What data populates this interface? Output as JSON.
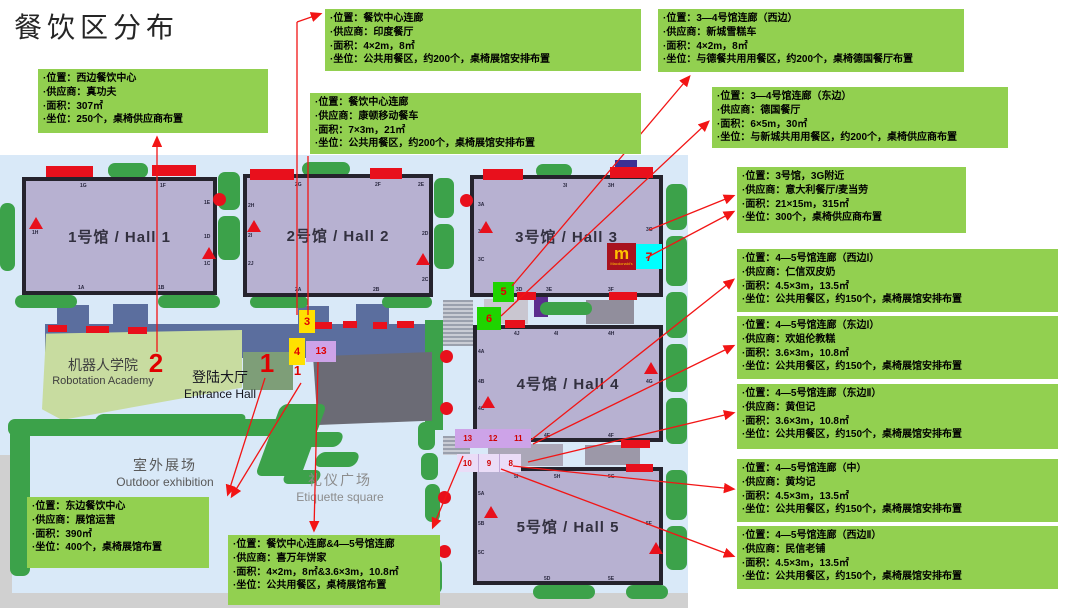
{
  "title": "餐饮区分布",
  "colors": {
    "box_green": "#92D050",
    "arrow_red": "#FF1515",
    "hall_fill": "#B7B1D1",
    "marker_yellow": "#FFE100",
    "marker_green": "#1FD400",
    "marker_cyan": "#00FFFF",
    "marker_purple": "#CDA3E8",
    "map_blue": "#D9E9F8",
    "corridor_blue": "#5B6E9E",
    "tree_green": "#3CA24A",
    "mcdonalds_red": "#A8121E",
    "mcdonalds_yellow": "#FFC300"
  },
  "boxes": [
    {
      "id": "west-dining-center",
      "pos": {
        "x": 38,
        "y": 69,
        "w": 230,
        "h": 64
      },
      "lines": [
        "·位置：西边餐饮中心",
        "·供应商：真功夫",
        "·面积：307㎡",
        "·坐位：250个，桌椅供应商布置"
      ]
    },
    {
      "id": "dining-corridor-india",
      "pos": {
        "x": 325,
        "y": 9,
        "w": 316,
        "h": 62
      },
      "lines": [
        "·位置：餐饮中心连廊",
        "·供应商：印度餐厅",
        "·面积：4×2m，8㎡",
        "·坐位：公共用餐区，约200个，桌椅展馆安排布置"
      ]
    },
    {
      "id": "dining-corridor-kangdun",
      "pos": {
        "x": 310,
        "y": 93,
        "w": 331,
        "h": 61
      },
      "lines": [
        "·位置：餐饮中心连廊",
        "·供应商：康顿移动餐车",
        "·面积：7×3m，21㎡",
        "·坐位：公共用餐区，约200个，桌椅展馆安排布置"
      ]
    },
    {
      "id": "hall34-corridor-west",
      "pos": {
        "x": 658,
        "y": 9,
        "w": 306,
        "h": 63
      },
      "lines": [
        "·位置：3—4号馆连廊（西边）",
        "·供应商：新城雪糕车",
        "·面积：4×2m，8㎡",
        "·坐位：与德餐共用用餐区，约200个，桌椅德国餐厅布置"
      ]
    },
    {
      "id": "hall34-corridor-east",
      "pos": {
        "x": 712,
        "y": 87,
        "w": 296,
        "h": 61
      },
      "lines": [
        "·位置：3—4号馆连廊（东边）",
        "·供应商：德国餐厅",
        "·面积：6×5m，30㎡",
        "·坐位：与新城共用用餐区，约200个，桌椅供应商布置"
      ]
    },
    {
      "id": "hall3-3g",
      "pos": {
        "x": 737,
        "y": 167,
        "w": 229,
        "h": 66
      },
      "lines": [
        "·位置：3号馆，3G附近",
        "·供应商：意大利餐厅/麦当劳",
        "·面积：21×15m，315㎡",
        "·坐位：300个，桌椅供应商布置"
      ]
    },
    {
      "id": "hall45-corridor-west1",
      "pos": {
        "x": 737,
        "y": 249,
        "w": 321,
        "h": 63
      },
      "lines": [
        "·位置：4—5号馆连廊（西边Ⅰ）",
        "·供应商：仁信双皮奶",
        "·面积：4.5×3m，13.5㎡",
        "·坐位：公共用餐区，约150个，桌椅展馆安排布置"
      ]
    },
    {
      "id": "hall45-corridor-east1",
      "pos": {
        "x": 737,
        "y": 316,
        "w": 321,
        "h": 63
      },
      "lines": [
        "·位置：4—5号馆连廊（东边Ⅰ）",
        "·供应商：欢姐伦教糕",
        "·面积：3.6×3m，10.8㎡",
        "·坐位：公共用餐区，约150个，桌椅展馆安排布置"
      ]
    },
    {
      "id": "hall45-corridor-east2",
      "pos": {
        "x": 737,
        "y": 384,
        "w": 321,
        "h": 65
      },
      "lines": [
        "·位置：4—5号馆连廊（东边Ⅱ）",
        "·供应商：黄但记",
        "·面积：3.6×3m，10.8㎡",
        "·坐位：公共用餐区，约150个，桌椅展馆安排布置"
      ]
    },
    {
      "id": "hall45-corridor-mid",
      "pos": {
        "x": 737,
        "y": 459,
        "w": 321,
        "h": 63
      },
      "lines": [
        "·位置：4—5号馆连廊（中）",
        "·供应商：黄均记",
        "·面积：4.5×3m，13.5㎡",
        "·坐位：公共用餐区，约150个，桌椅展馆安排布置"
      ]
    },
    {
      "id": "hall45-corridor-west2",
      "pos": {
        "x": 737,
        "y": 526,
        "w": 321,
        "h": 63
      },
      "lines": [
        "·位置：4—5号馆连廊（西边Ⅱ）",
        "·供应商：民信老铺",
        "·面积：4.5×3m，13.5㎡",
        "·坐位：公共用餐区，约150个，桌椅展馆安排布置"
      ]
    },
    {
      "id": "east-dining-center",
      "pos": {
        "x": 27,
        "y": 497,
        "w": 182,
        "h": 71
      },
      "lines": [
        "·位置：东边餐饮中心",
        "·供应商：展馆运营",
        "·面积：390㎡",
        "·坐位：400个，桌椅展馆布置"
      ]
    },
    {
      "id": "dining-and-hall45-corridor",
      "pos": {
        "x": 228,
        "y": 535,
        "w": 212,
        "h": 70
      },
      "lines": [
        "·位置：餐饮中心连廊&4—5号馆连廊",
        "·供应商：喜万年饼家",
        "·面积：4×2m，8㎡&3.6×3m，10.8㎡",
        "·坐位：公共用餐区，桌椅展馆布置"
      ]
    }
  ],
  "map": {
    "areas": {
      "academy_zh": "机器人学院",
      "academy_en": "Robotation Academy",
      "entrance_zh": "登陆大厅",
      "entrance_en": "Entrance Hall",
      "outdoor_zh": "室外展场",
      "outdoor_en": "Outdoor exhibition",
      "square_zh": "礼仪广场",
      "square_en": "Etiquette square"
    },
    "halls": [
      {
        "label": "1号馆 / Hall 1",
        "x": 22,
        "y": 177,
        "w": 195,
        "h": 118,
        "gates": [
          [
            "1G",
            80,
            183
          ],
          [
            "1F",
            160,
            183
          ],
          [
            "1E",
            204,
            200
          ],
          [
            "1D",
            204,
            234
          ],
          [
            "1C",
            204,
            261
          ],
          [
            "1H",
            32,
            230
          ],
          [
            "1A",
            78,
            285
          ],
          [
            "1B",
            158,
            285
          ]
        ]
      },
      {
        "label": "2号馆 / Hall 2",
        "x": 243,
        "y": 174,
        "w": 190,
        "h": 123,
        "gates": [
          [
            "2G",
            295,
            182
          ],
          [
            "2F",
            375,
            182
          ],
          [
            "2E",
            418,
            182
          ],
          [
            "2H",
            248,
            203
          ],
          [
            "2I",
            248,
            233
          ],
          [
            "2J",
            248,
            261
          ],
          [
            "2A",
            295,
            287
          ],
          [
            "2B",
            373,
            287
          ],
          [
            "2C",
            422,
            277
          ],
          [
            "2D",
            422,
            231
          ]
        ]
      },
      {
        "label": "3号馆 / Hall 3",
        "x": 470,
        "y": 175,
        "w": 193,
        "h": 122,
        "gates": [
          [
            "3I",
            563,
            183
          ],
          [
            "3H",
            608,
            183
          ],
          [
            "3A",
            478,
            202
          ],
          [
            "3B",
            478,
            229
          ],
          [
            "3C",
            478,
            257
          ],
          [
            "3D",
            516,
            287
          ],
          [
            "3E",
            546,
            287
          ],
          [
            "3F",
            608,
            287
          ],
          [
            "3G",
            646,
            227
          ]
        ]
      },
      {
        "label": "4号馆 / Hall 4",
        "x": 473,
        "y": 325,
        "w": 190,
        "h": 117,
        "gates": [
          [
            "4J",
            514,
            331
          ],
          [
            "4I",
            554,
            331
          ],
          [
            "4H",
            608,
            331
          ],
          [
            "4A",
            478,
            349
          ],
          [
            "4B",
            478,
            379
          ],
          [
            "4C",
            478,
            406
          ],
          [
            "4E",
            544,
            433
          ],
          [
            "4F",
            608,
            433
          ],
          [
            "4G",
            646,
            379
          ]
        ]
      },
      {
        "label": "5号馆 / Hall 5",
        "x": 473,
        "y": 467,
        "w": 190,
        "h": 118,
        "gates": [
          [
            "5I",
            514,
            474
          ],
          [
            "5H",
            554,
            474
          ],
          [
            "5G",
            608,
            474
          ],
          [
            "5A",
            478,
            491
          ],
          [
            "5B",
            478,
            521
          ],
          [
            "5C",
            478,
            550
          ],
          [
            "5D",
            544,
            576
          ],
          [
            "5E",
            608,
            576
          ],
          [
            "5F",
            646,
            521
          ]
        ]
      }
    ],
    "markers": [
      {
        "t": "3",
        "x": 299,
        "y": 310,
        "w": 16,
        "h": 23,
        "bg": "#FFE100",
        "fs": 11
      },
      {
        "t": "4",
        "x": 289,
        "y": 338,
        "w": 16,
        "h": 27,
        "bg": "#FFE100",
        "fs": 11
      },
      {
        "t": "13",
        "x": 306,
        "y": 341,
        "w": 30,
        "h": 21,
        "bg": "#CDA3E8",
        "fs": 10
      },
      {
        "t": "5",
        "x": 493,
        "y": 282,
        "w": 21,
        "h": 20,
        "bg": "#1FD400",
        "fs": 11
      },
      {
        "t": "6",
        "x": 477,
        "y": 307,
        "w": 24,
        "h": 23,
        "bg": "#1FD400",
        "fs": 11
      },
      {
        "t": "7",
        "x": 636,
        "y": 244,
        "w": 26,
        "h": 25,
        "bg": "#00FFFF",
        "fs": 12
      },
      {
        "t": "1",
        "x": 255,
        "y": 348,
        "w": 24,
        "h": 30,
        "bg": "",
        "fs": 26
      },
      {
        "t": "2",
        "x": 144,
        "y": 348,
        "w": 24,
        "h": 30,
        "bg": "",
        "fs": 26
      },
      {
        "t": "1",
        "x": 291,
        "y": 362,
        "w": 13,
        "h": 16,
        "bg": "",
        "fs": 13
      }
    ],
    "strips": [
      {
        "cells": [
          "13",
          "12",
          "11"
        ],
        "x": 455,
        "y": 429,
        "w": 76,
        "h": 19,
        "bg": "#CDA3E8",
        "divided": false
      },
      {
        "cells": [
          "10",
          "9",
          "8"
        ],
        "x": 457,
        "y": 454,
        "w": 64,
        "h": 18,
        "bg": "#EADCF7",
        "divided": true
      }
    ],
    "mcd": {
      "m": "m",
      "sub": "Macdonald's",
      "x": 607,
      "y": 243,
      "w": 29,
      "h": 27
    },
    "trees": [
      [
        108,
        163,
        40,
        15
      ],
      [
        302,
        162,
        48,
        14
      ],
      [
        536,
        164,
        36,
        14
      ],
      [
        0,
        203,
        15,
        68
      ],
      [
        218,
        172,
        22,
        38
      ],
      [
        218,
        216,
        22,
        44
      ],
      [
        434,
        178,
        20,
        40
      ],
      [
        434,
        224,
        20,
        45
      ],
      [
        666,
        184,
        21,
        46
      ],
      [
        666,
        236,
        21,
        50
      ],
      [
        666,
        292,
        21,
        46
      ],
      [
        666,
        344,
        21,
        48
      ],
      [
        666,
        398,
        21,
        46
      ],
      [
        666,
        470,
        21,
        50
      ],
      [
        666,
        526,
        21,
        44
      ],
      [
        15,
        295,
        62,
        13
      ],
      [
        158,
        295,
        62,
        13
      ],
      [
        250,
        296,
        58,
        12
      ],
      [
        382,
        296,
        50,
        12
      ],
      [
        540,
        302,
        52,
        13
      ],
      [
        536,
        430,
        55,
        12
      ],
      [
        533,
        585,
        62,
        14
      ],
      [
        626,
        585,
        42,
        14
      ],
      [
        8,
        419,
        300,
        17
      ],
      [
        10,
        428,
        20,
        148
      ],
      [
        418,
        422,
        17,
        28
      ],
      [
        421,
        453,
        17,
        27
      ],
      [
        425,
        484,
        15,
        38
      ],
      [
        427,
        558,
        15,
        36
      ]
    ],
    "skew_trees": [
      [
        300,
        432,
        42,
        15
      ],
      [
        316,
        452,
        42,
        15
      ],
      [
        284,
        470,
        36,
        14
      ],
      [
        95,
        414,
        150,
        12
      ],
      [
        268,
        404,
        46,
        72
      ]
    ],
    "gray": [
      {
        "x": 45,
        "y": 324,
        "w": 380,
        "h": 34,
        "c": "#5B6E9E"
      },
      {
        "x": 57,
        "y": 305,
        "w": 32,
        "h": 22,
        "c": "#5B6E9E"
      },
      {
        "x": 113,
        "y": 304,
        "w": 35,
        "h": 23,
        "c": "#5B6E9E"
      },
      {
        "x": 298,
        "y": 306,
        "w": 31,
        "h": 21,
        "c": "#5B6E9E"
      },
      {
        "x": 356,
        "y": 304,
        "w": 33,
        "h": 23,
        "c": "#5B6E9E"
      },
      {
        "x": 425,
        "y": 320,
        "w": 18,
        "h": 110,
        "c": "#3CA24A"
      },
      {
        "x": 484,
        "y": 299,
        "w": 44,
        "h": 25,
        "c": "#C9C6D0"
      },
      {
        "x": 586,
        "y": 300,
        "w": 48,
        "h": 24,
        "c": "#918E9C"
      },
      {
        "x": 488,
        "y": 444,
        "w": 75,
        "h": 22,
        "c": "#ABA7B8"
      },
      {
        "x": 585,
        "y": 445,
        "w": 55,
        "h": 20,
        "c": "#9C98A8"
      },
      {
        "x": 147,
        "y": 352,
        "w": 52,
        "h": 38,
        "c": "#7E9E78"
      },
      {
        "x": 243,
        "y": 352,
        "w": 50,
        "h": 38,
        "c": "#7E9E78"
      },
      {
        "x": 0,
        "y": 455,
        "w": 12,
        "h": 153,
        "c": "#D0D0D0"
      },
      {
        "x": 0,
        "y": 593,
        "w": 737,
        "h": 15,
        "c": "#D0D0D0"
      },
      {
        "x": 688,
        "y": 155,
        "w": 49,
        "h": 453,
        "c": "#FFFFFF"
      },
      {
        "x": 615,
        "y": 160,
        "w": 22,
        "h": 9,
        "c": "#3B3094"
      },
      {
        "x": 534,
        "y": 287,
        "w": 14,
        "h": 30,
        "c": "#5B2D8E"
      }
    ],
    "academy": {
      "x": 42,
      "y": 330,
      "w": 200,
      "h": 90,
      "c": "#C8DCA0"
    },
    "entrance": {
      "x": 313,
      "y": 352,
      "w": 119,
      "h": 73,
      "c": "#6B6B75"
    },
    "ramps": [
      [
        443,
        300,
        30,
        46
      ],
      [
        443,
        436,
        27,
        19
      ]
    ],
    "red_bars": [
      [
        46,
        166,
        47,
        11
      ],
      [
        152,
        165,
        44,
        11
      ],
      [
        250,
        169,
        44,
        11
      ],
      [
        370,
        168,
        32,
        11
      ],
      [
        483,
        169,
        40,
        11
      ],
      [
        610,
        167,
        43,
        11
      ],
      [
        517,
        292,
        19,
        8
      ],
      [
        609,
        292,
        28,
        8
      ],
      [
        505,
        320,
        20,
        8
      ],
      [
        621,
        440,
        29,
        8
      ],
      [
        626,
        464,
        27,
        8
      ],
      [
        48,
        325,
        19,
        7
      ],
      [
        86,
        326,
        23,
        7
      ],
      [
        128,
        327,
        19,
        7
      ],
      [
        315,
        322,
        17,
        7
      ],
      [
        343,
        321,
        14,
        7
      ],
      [
        373,
        322,
        14,
        7
      ],
      [
        397,
        321,
        17,
        7
      ]
    ],
    "circles": [
      [
        219,
        199
      ],
      [
        466,
        200
      ],
      [
        446,
        356
      ],
      [
        446,
        408
      ],
      [
        444,
        497
      ],
      [
        444,
        551
      ]
    ],
    "triangles": [
      [
        29,
        217
      ],
      [
        202,
        247
      ],
      [
        247,
        220
      ],
      [
        416,
        253
      ],
      [
        479,
        221
      ],
      [
        481,
        396
      ],
      [
        644,
        362
      ],
      [
        484,
        506
      ],
      [
        649,
        542
      ]
    ],
    "arrows": [
      [
        157,
        352,
        157,
        138,
        1
      ],
      [
        297,
        315,
        297,
        22,
        0
      ],
      [
        297,
        22,
        320,
        14,
        1
      ],
      [
        308,
        315,
        308,
        156,
        0
      ],
      [
        512,
        286,
        689,
        77,
        1
      ],
      [
        501,
        316,
        708,
        122,
        1
      ],
      [
        649,
        230,
        733,
        196,
        1
      ],
      [
        646,
        258,
        733,
        212,
        1
      ],
      [
        531,
        440,
        733,
        280,
        1
      ],
      [
        533,
        444,
        733,
        346,
        1
      ],
      [
        528,
        462,
        733,
        413,
        1
      ],
      [
        513,
        466,
        733,
        489,
        1
      ],
      [
        501,
        469,
        733,
        556,
        1
      ],
      [
        265,
        378,
        228,
        494,
        1
      ],
      [
        301,
        383,
        232,
        496,
        1
      ],
      [
        318,
        362,
        314,
        530,
        1
      ],
      [
        463,
        456,
        433,
        527,
        1
      ]
    ]
  }
}
